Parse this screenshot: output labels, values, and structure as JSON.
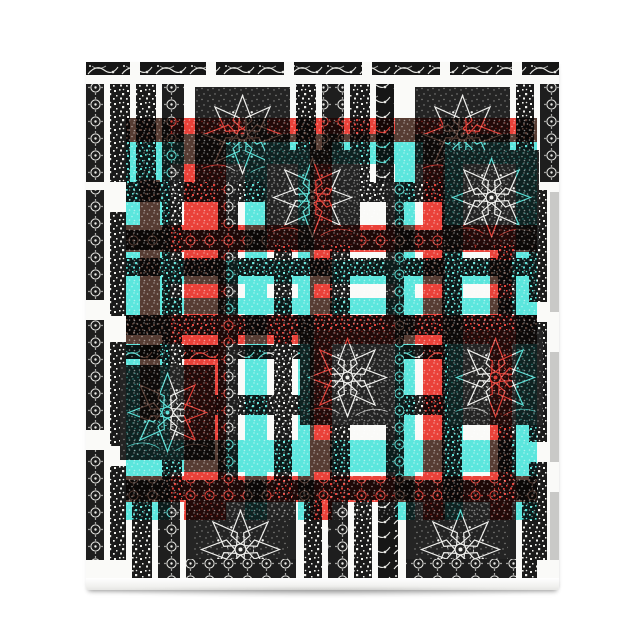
{
  "product": {
    "name": "Ornamental plaid notepad",
    "alt": "Notepad product photo: white background, pad printed with a black and white ethnic ornament pattern of speckled bars, rosette dot columns, leaf scroll bands and large pinwheel flower medallions, overlaid with a translucent red and turquoise plaid grid; plain white page edge with slight shadow at the bottom",
    "kind": "notepad product photograph",
    "text_content": "none (image contains no readable text)"
  },
  "palette": {
    "background": "#ffffff",
    "paper": "#fbfbfa",
    "ink": "#1c1c1c",
    "ornament_white": "#f0f0ec",
    "red": "#ee2d24",
    "cyan": "#40e8e0",
    "page_edge": "#c9c9c7",
    "shadow": "#dededc"
  },
  "pattern": {
    "style": "ethnic ornamental plaid",
    "base": "black and white ornament",
    "overlay": "translucent red and turquoise plaid stripes",
    "motifs": [
      "pinwheel-flower-medallion",
      "rosette-dot-column",
      "speckled-bar",
      "leaf-scroll-band",
      "rosette-row"
    ]
  }
}
